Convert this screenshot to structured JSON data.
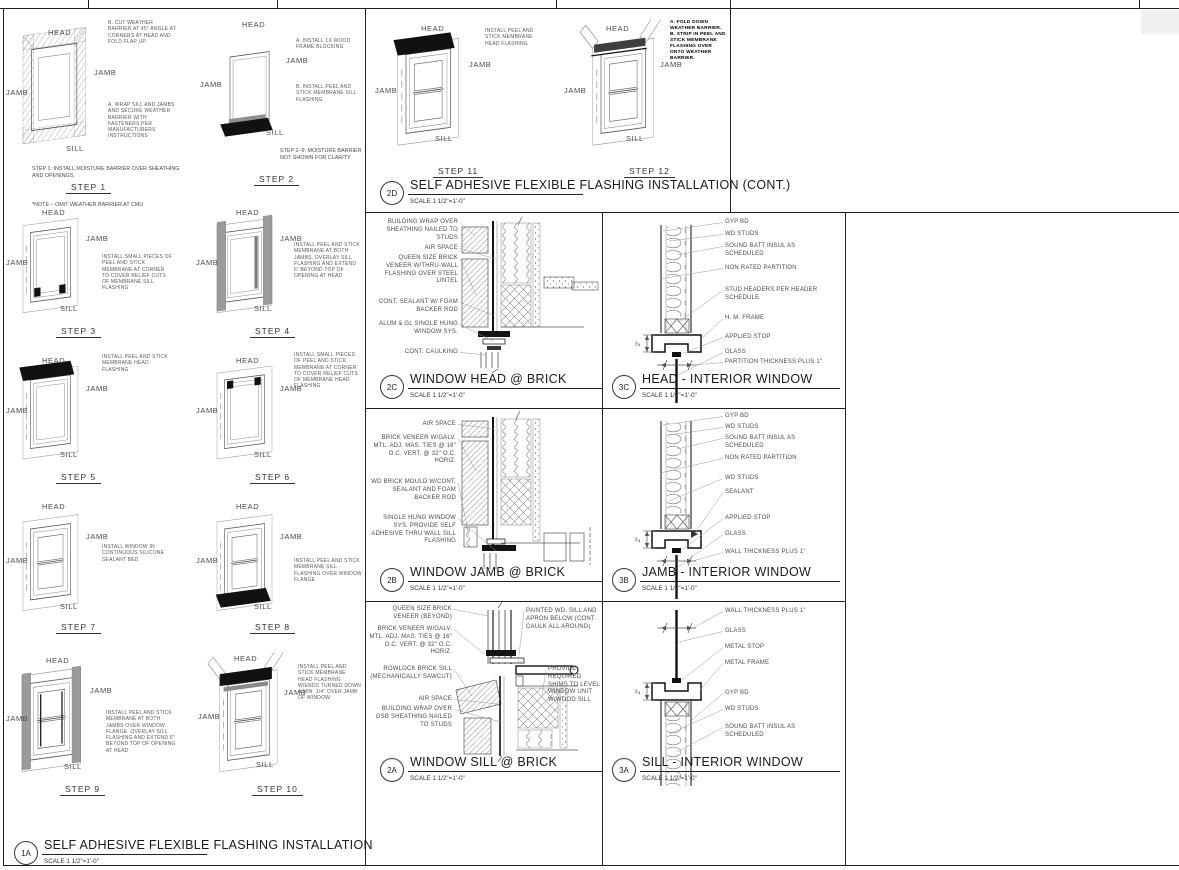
{
  "common": {
    "head": "HEAD",
    "jamb": "JAMB",
    "sill": "SILL"
  },
  "panels": {
    "p1a": {
      "id": "1A",
      "title": "SELF ADHESIVE FLEXIBLE FLASHING INSTALLATION",
      "scale": "SCALE 1 1/2\"=1'-0\"",
      "steps": [
        {
          "name": "STEP 1",
          "notes": [
            "B. CUT WEATHER BARRIER AT 45° ANGLE AT CORNERS AT HEAD AND FOLD FLAP UP.",
            "A. WRAP SILL AND JAMBS AND SECURE WEATHER BARRIER WITH FASTENERS PER MANUFACTURERS INSTRUCTIONS"
          ],
          "caption": "STEP 1: INSTALL MOISTURE BARRIER OVER SHEATHING AND OPENINGS.",
          "footnote": "*NOTE – OMIT WEATHER BARRIER AT CMU"
        },
        {
          "name": "STEP 2",
          "notes": [
            "A. INSTALL 1X WOOD FRAME BLOCKING",
            "B. INSTALL PEEL AND STICK MEMBRANE SILL FLASHING"
          ],
          "caption": "STEP 2–9: MOISTURE BARRIER NOT SHOWN FOR CLARITY"
        },
        {
          "name": "STEP 3",
          "notes": [
            "INSTALL SMALL PIECES OF PEEL AND STICK MEMBRANE AT CORNER TO COVER RELIEF CUTS OF MEMBRANE SILL FLASHING"
          ]
        },
        {
          "name": "STEP 4",
          "notes": [
            "INSTALL PEEL AND STICK MEMBRANE AT BOTH JAMBS. OVERLAY SILL FLASHING AND EXTEND 6\" BEYOND TOP OF OPENING AT HEAD"
          ]
        },
        {
          "name": "STEP 5",
          "notes": [
            "INSTALL PEEL AND STICK MEMBRANE HEAD FLASHING"
          ]
        },
        {
          "name": "STEP 6",
          "notes": [
            "INSTALL SMALL PIECES OF PEEL AND STICK MEMBRANE AT CORNER TO COVER RELIEF CUTS OF MEMBRANE HEAD FLASHING"
          ]
        },
        {
          "name": "STEP 7",
          "notes": [
            "INSTALL WINDOW IN CONTINUOUS SILICONE SEALANT BED"
          ]
        },
        {
          "name": "STEP 8",
          "notes": [
            "INSTALL PEEL AND STICK MEMBRANE SILL FLASHING OVER WINDOW FLANGE"
          ]
        },
        {
          "name": "STEP 9",
          "notes": [
            "INSTALL PEEL AND STICK MEMBRANE AT BOTH JAMBS OVER WINDOW FLANGE. OVERLAY SILL FLASHING AND EXTEND 6\" BEYOND TOP OF OPENING AT HEAD"
          ]
        },
        {
          "name": "STEP 10",
          "notes": [
            "INSTALL PEEL AND STICK MEMBRANE HEAD FLASHING W/ENDS TURNED DOWN A MIN. 1/4\" OVER JAMB OF WINDOW."
          ]
        }
      ]
    },
    "p2d": {
      "id": "2D",
      "title": "SELF ADHESIVE FLEXIBLE FLASHING INSTALLATION (CONT.)",
      "scale": "SCALE 1 1/2\"=1'-0\"",
      "steps": [
        {
          "name": "STEP 11",
          "notes": [
            "INSTALL PEEL AND STICK MEMBRANE HEAD FLASHING"
          ]
        },
        {
          "name": "STEP 12",
          "notes": [
            "A. FOLD DOWN WEATHER BARRIER. B. STRIP IN PEEL AND STICK MEMBRANE FLASHING OVER ONTO WEATHER BARRIER."
          ]
        }
      ]
    },
    "p2c": {
      "id": "2C",
      "title": "WINDOW HEAD @ BRICK",
      "scale": "SCALE 1 1/2\"=1'-0\"",
      "labels": [
        "BUILDING WRAP OVER SHEATHING NAILED TO STUDS",
        "AIR SPACE",
        "QUEEN SIZE BRICK VENEER W/THRU-WALL FLASHING OVER STEEL LINTEL",
        "CONT. SEALANT W/ FOAM BACKER ROD",
        "ALUM & GL SINGLE HUNG WINDOW SYS.",
        "CONT. CAULKING"
      ]
    },
    "p3c": {
      "id": "3C",
      "title": "HEAD - INTERIOR WINDOW",
      "scale": "SCALE 1 1/2\"=1'-0\"",
      "dimension": "2\"",
      "labels": [
        "GYP BD",
        "WD STUDS",
        "SOUND BATT INSUL AS SCHEDULED",
        "NON RATED PARTITION",
        "STUD HEADERS PER HEADER SCHEDULE",
        "H. M. FRAME",
        "APPLIED STOP",
        "GLASS",
        "PARTITION THICKNESS PLUS 1\""
      ]
    },
    "p2b": {
      "id": "2B",
      "title": "WINDOW JAMB @ BRICK",
      "scale": "SCALE 1 1/2\"=1'-0\"",
      "labels": [
        "AIR SPACE",
        "BRICK VENEER W/GALV. MTL. ADJ. MAS. TIES @ 16\" O.C. VERT. @ 32\" O.C. HORIZ.",
        "WD BRICK MOULD W/CONT. SEALANT AND FOAM BACKER ROD",
        "SINGLE HUNG WINDOW SYS. PROVIDE SELF ADHESIVE THRU WALL SILL FLASHING"
      ]
    },
    "p3b": {
      "id": "3B",
      "title": "JAMB - INTERIOR WINDOW",
      "scale": "SCALE 1 1/2\"=1'-0\"",
      "dimension": "2\"",
      "labels": [
        "GYP BD",
        "WD STUDS",
        "SOUND BATT INSUL AS SCHEDULED",
        "NON RATED PARTITION",
        "WD STUDS",
        "SEALANT",
        "APPLIED STOP",
        "GLASS",
        "WALL THICKNESS PLUS 1\""
      ]
    },
    "p2a": {
      "id": "2A",
      "title": "WINDOW SILL @ BRICK",
      "scale": "SCALE 1 1/2\"=1'-0\"",
      "labels": [
        "QUEEN SIZE BRICK VENEER (BEYOND)",
        "BRICK VENEER W/GALV. MTL. ADJ. MAS. TIES @ 16\" O.C. VERT. @ 32\" O.C. HORIZ.",
        "ROWLOCK BRICK SILL (MECHANICALLY SAWCUT)",
        "AIR SPACE",
        "BUILDING WRAP OVER OSB SHEATHING NAILED TO STUDS",
        "PAINTED WD. SILL AND APRON BELOW (CONT. CAULK ALL AROUND)",
        "PROVIDE REQUIRED SHIMS TO LEVEL WINDOW UNIT W/WOOD SILL"
      ]
    },
    "p3a": {
      "id": "3A",
      "title": "SILL - INTERIOR WINDOW",
      "scale": "SCALE 1 1/2\"=1'-0\"",
      "dimension": "2\"",
      "labels": [
        "WALL THICKNESS PLUS 1\"",
        "GLASS",
        "METAL STOP",
        "METAL FRAME",
        "GYP BD",
        "WD STUDS",
        "SOUND BATT INSUL AS SCHEDULED"
      ]
    }
  }
}
